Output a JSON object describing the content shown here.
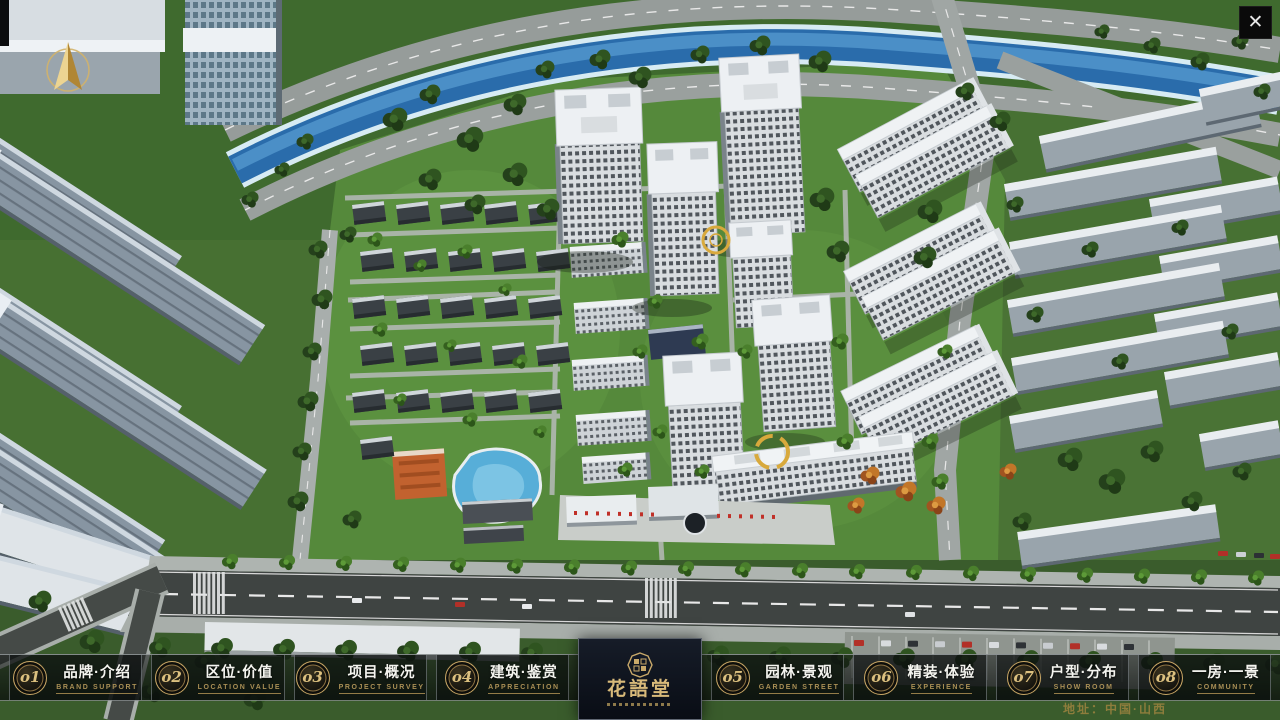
{
  "icons": {
    "close": "✕"
  },
  "menu": {
    "items": [
      {
        "num": "o1",
        "cn": "品牌·介绍",
        "en": "BRAND SUPPORT"
      },
      {
        "num": "o2",
        "cn": "区位·价值",
        "en": "LOCATION VALUE"
      },
      {
        "num": "o3",
        "cn": "项目·概况",
        "en": "PROJECT SURVEY"
      },
      {
        "num": "o4",
        "cn": "建筑·鉴赏",
        "en": "APPRECIATION"
      },
      {
        "num": "o5",
        "cn": "园林·景观",
        "en": "GARDEN STREET"
      },
      {
        "num": "o6",
        "cn": "精装·体验",
        "en": "EXPERIENCE"
      },
      {
        "num": "o7",
        "cn": "户型·分布",
        "en": "SHOW ROOM"
      },
      {
        "num": "o8",
        "cn": "一房·一景",
        "en": "COMMUNITY"
      }
    ]
  },
  "logo": {
    "name": "花語堂"
  },
  "footer": {
    "address": "地址：中国·山西"
  },
  "theme": {
    "gold": "#c8a665",
    "gold_dark": "#8f7443",
    "text_white": "#f4f4ef"
  }
}
